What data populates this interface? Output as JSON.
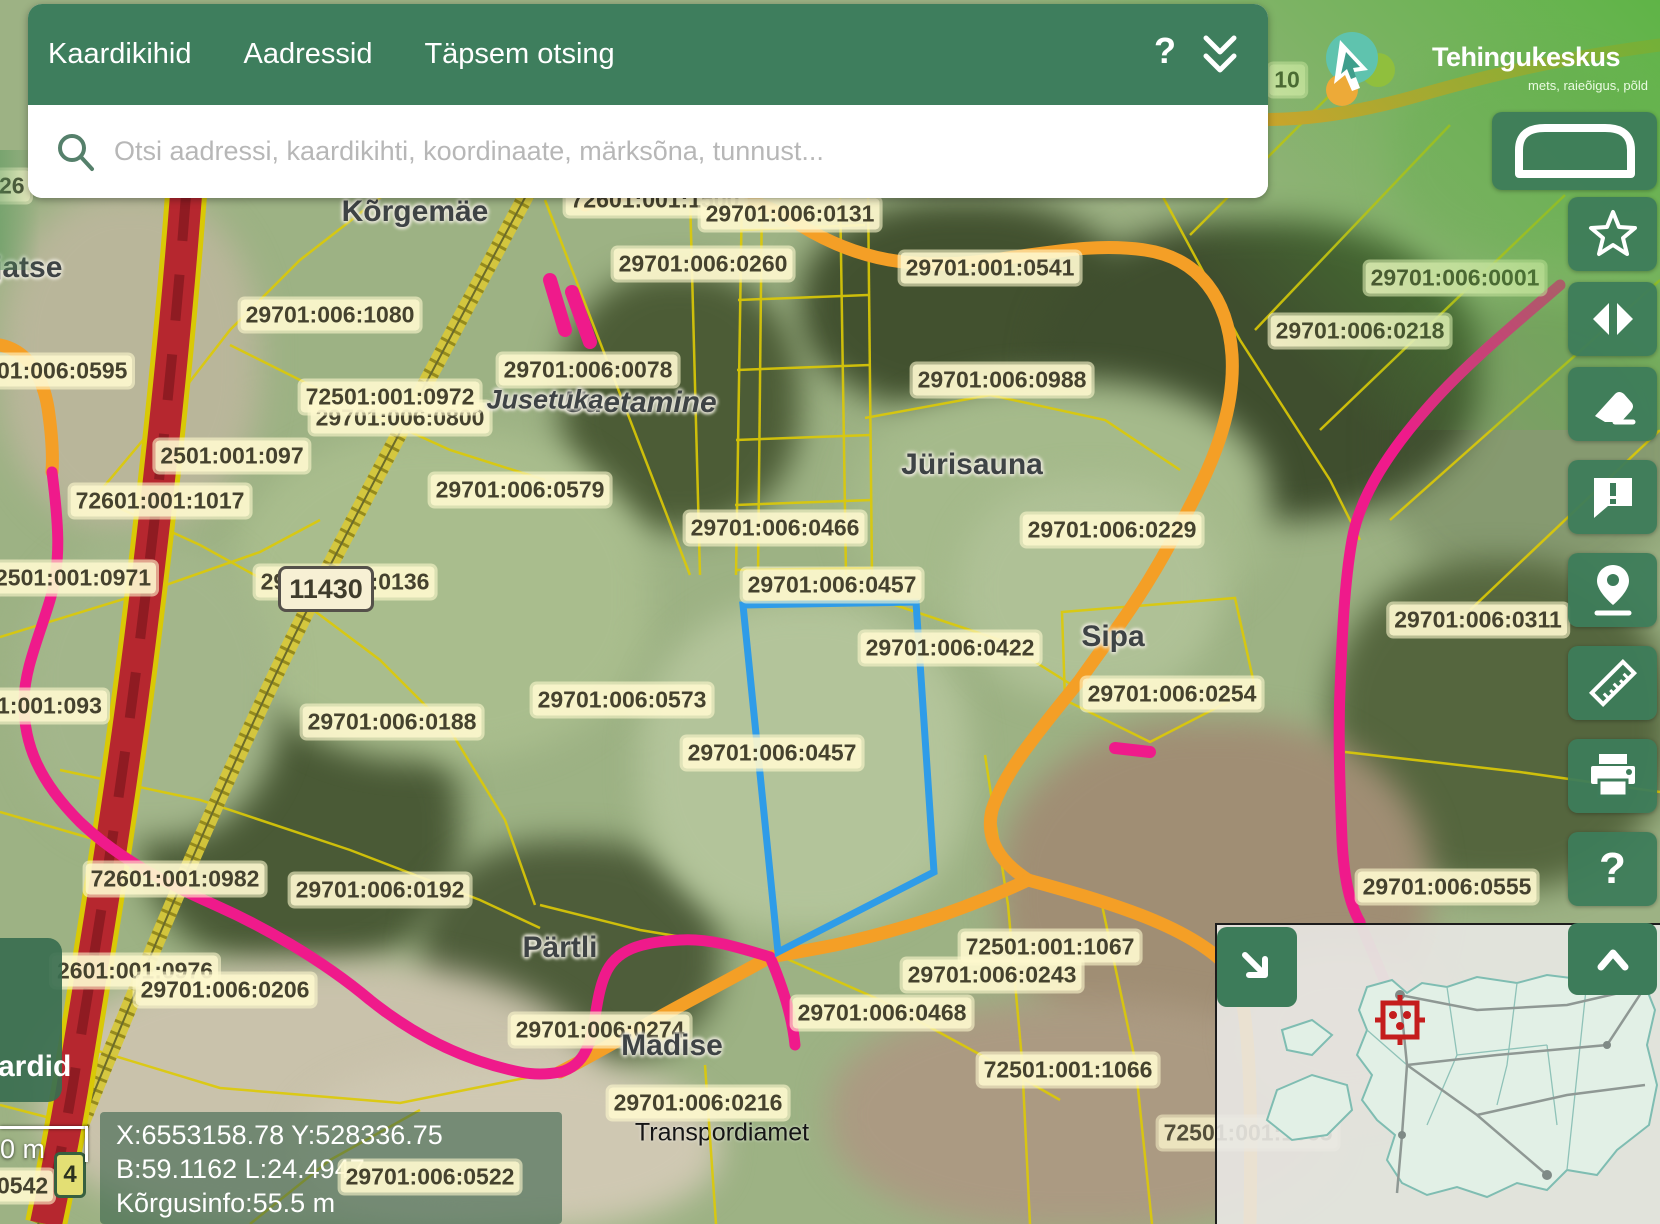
{
  "header": {
    "menu_items": [
      "Kaardikihid",
      "Aadressid",
      "Täpsem otsing"
    ],
    "help_label": "?",
    "collapse_icon": "double-chevron-down"
  },
  "search": {
    "placeholder": "Otsi aadressi, kaardikihti, koordinaate, märksõna, tunnust..."
  },
  "logo": {
    "name": "Tehingukeskus",
    "tagline": "mets, raieõigus, põld"
  },
  "sidebar": {
    "tools": [
      {
        "name": "basemap",
        "icon": "basemap-arch-icon"
      },
      {
        "name": "favorites",
        "icon": "star-icon"
      },
      {
        "name": "compare",
        "icon": "left-right-arrows-icon"
      },
      {
        "name": "erase",
        "icon": "eraser-icon"
      },
      {
        "name": "feedback",
        "icon": "comment-exclamation-icon"
      },
      {
        "name": "locate",
        "icon": "location-pin-icon"
      },
      {
        "name": "measure",
        "icon": "ruler-icon"
      },
      {
        "name": "print",
        "icon": "printer-icon"
      },
      {
        "name": "help",
        "icon": "question-mark",
        "label": "?"
      }
    ]
  },
  "map": {
    "parcel_labels": [
      {
        "t": "72601:001:1500",
        "x": 655,
        "y": 200
      },
      {
        "t": "29701:006:0131",
        "x": 790,
        "y": 214
      },
      {
        "t": "29701:006:0260",
        "x": 703,
        "y": 264
      },
      {
        "t": "29701:001:0541",
        "x": 990,
        "y": 268
      },
      {
        "t": "29701:006:1080",
        "x": 330,
        "y": 315
      },
      {
        "t": "01:006:0595",
        "x": 0,
        "y": 371,
        "lx": -8
      },
      {
        "t": "26",
        "x": 0,
        "y": 186,
        "lx": -6
      },
      {
        "t": "29701:006:0078",
        "x": 588,
        "y": 370
      },
      {
        "t": "29701:006:0800",
        "x": 400,
        "y": 418
      },
      {
        "t": "72501:001:0972",
        "x": 390,
        "y": 397
      },
      {
        "t": "2501:001:097",
        "x": 232,
        "y": 456
      },
      {
        "t": "29701:006:0579",
        "x": 520,
        "y": 490
      },
      {
        "t": "29701:006:0988",
        "x": 1002,
        "y": 380
      },
      {
        "t": "29701:006:0001",
        "x": 1455,
        "y": 278
      },
      {
        "t": "29701:006:0218",
        "x": 1360,
        "y": 331
      },
      {
        "t": "72601:001:1017",
        "x": 160,
        "y": 501
      },
      {
        "t": "2501:001:0971",
        "x": 0,
        "y": 578,
        "lx": -10
      },
      {
        "t": "29701:006:0136",
        "x": 345,
        "y": 582
      },
      {
        "t": "29701:006:0466",
        "x": 775,
        "y": 528
      },
      {
        "t": "29701:006:0457",
        "x": 832,
        "y": 585
      },
      {
        "t": "29701:006:0422",
        "x": 950,
        "y": 648
      },
      {
        "t": "29701:006:0229",
        "x": 1112,
        "y": 530
      },
      {
        "t": "29701:006:0311",
        "x": 1478,
        "y": 620
      },
      {
        "t": "29701:006:0254",
        "x": 1172,
        "y": 694
      },
      {
        "t": "29701:006:0573",
        "x": 622,
        "y": 700
      },
      {
        "t": "29701:006:0457",
        "x": 772,
        "y": 753
      },
      {
        "t": "29701:006:0188",
        "x": 392,
        "y": 722
      },
      {
        "t": "1:001:093",
        "x": 0,
        "y": 706,
        "lx": -8
      },
      {
        "t": "29701:006:0555",
        "x": 1447,
        "y": 887
      },
      {
        "t": "72601:001:0982",
        "x": 175,
        "y": 879
      },
      {
        "t": "29701:006:0192",
        "x": 380,
        "y": 890
      },
      {
        "t": "2601:001:0976",
        "x": 0,
        "y": 971,
        "lx": 52
      },
      {
        "t": "29701:006:0206",
        "x": 225,
        "y": 990
      },
      {
        "t": "29701:006:0274",
        "x": 600,
        "y": 1030
      },
      {
        "t": "29701:006:0468",
        "x": 882,
        "y": 1013
      },
      {
        "t": "29701:006:0243",
        "x": 992,
        "y": 975
      },
      {
        "t": "72501:001:1067",
        "x": 1050,
        "y": 947
      },
      {
        "t": "72501:001:1066",
        "x": 1068,
        "y": 1070
      },
      {
        "t": "29701:006:0216",
        "x": 698,
        "y": 1103
      },
      {
        "t": "0542",
        "x": 0,
        "y": 1186,
        "lx": -8
      },
      {
        "t": "10",
        "x": 1287,
        "y": 80
      },
      {
        "t": "72501:001:1065",
        "x": 1248,
        "y": 1133,
        "ghost": true
      }
    ],
    "overlay_labels": [
      {
        "t": "29701:006:0522",
        "x": 430,
        "y": 1177
      }
    ],
    "place_labels": [
      {
        "t": "Kõrgemäe",
        "x": 415,
        "y": 212
      },
      {
        "t": "jatse",
        "x": 0,
        "y": 268,
        "lx": -6
      },
      {
        "t": "Uuetamine",
        "x": 640,
        "y": 403,
        "i": true
      },
      {
        "t": "Jusetuka",
        "x": 545,
        "y": 400,
        "i": true,
        "fs": 27
      },
      {
        "t": "Jürisauna",
        "x": 972,
        "y": 465
      },
      {
        "t": "Sipa",
        "x": 1113,
        "y": 637
      },
      {
        "t": "Pärtli",
        "x": 560,
        "y": 948
      },
      {
        "t": "Madise",
        "x": 672,
        "y": 1046
      }
    ],
    "attribution": "Transpordiamet",
    "road_badges": {
      "main": "11430",
      "small": "4"
    },
    "highlighted_parcel": {
      "number": "29701:006:0457",
      "outline_color": "#2f9ce8"
    }
  },
  "status": {
    "line1": "X:6553158.78 Y:528336.75",
    "line2": "B:59.1162 L:24.4947",
    "line3": "Kõrgusinfo:55.5 m",
    "scale_label": "0 m"
  },
  "layers_tab": {
    "label": "ardid"
  },
  "minimap": {
    "region": "Estonia",
    "marker": "red-target-icon"
  },
  "colors": {
    "header_green": "#3e7e5d",
    "button_green": "#3d7c5a",
    "label_bg": "#fdf8cd",
    "label_text": "#45422e",
    "road_orange": "#f49f26",
    "road_pink": "#ef1a8b",
    "road_red": "#b6272f",
    "boundary_yellow": "#ddca06",
    "road_olive": "#c8b52f",
    "parcel_blue": "#2f9ce8",
    "logo_teal": "#5fc3ae",
    "logo_green": "#90bf3d",
    "logo_orange": "#edaa38"
  }
}
